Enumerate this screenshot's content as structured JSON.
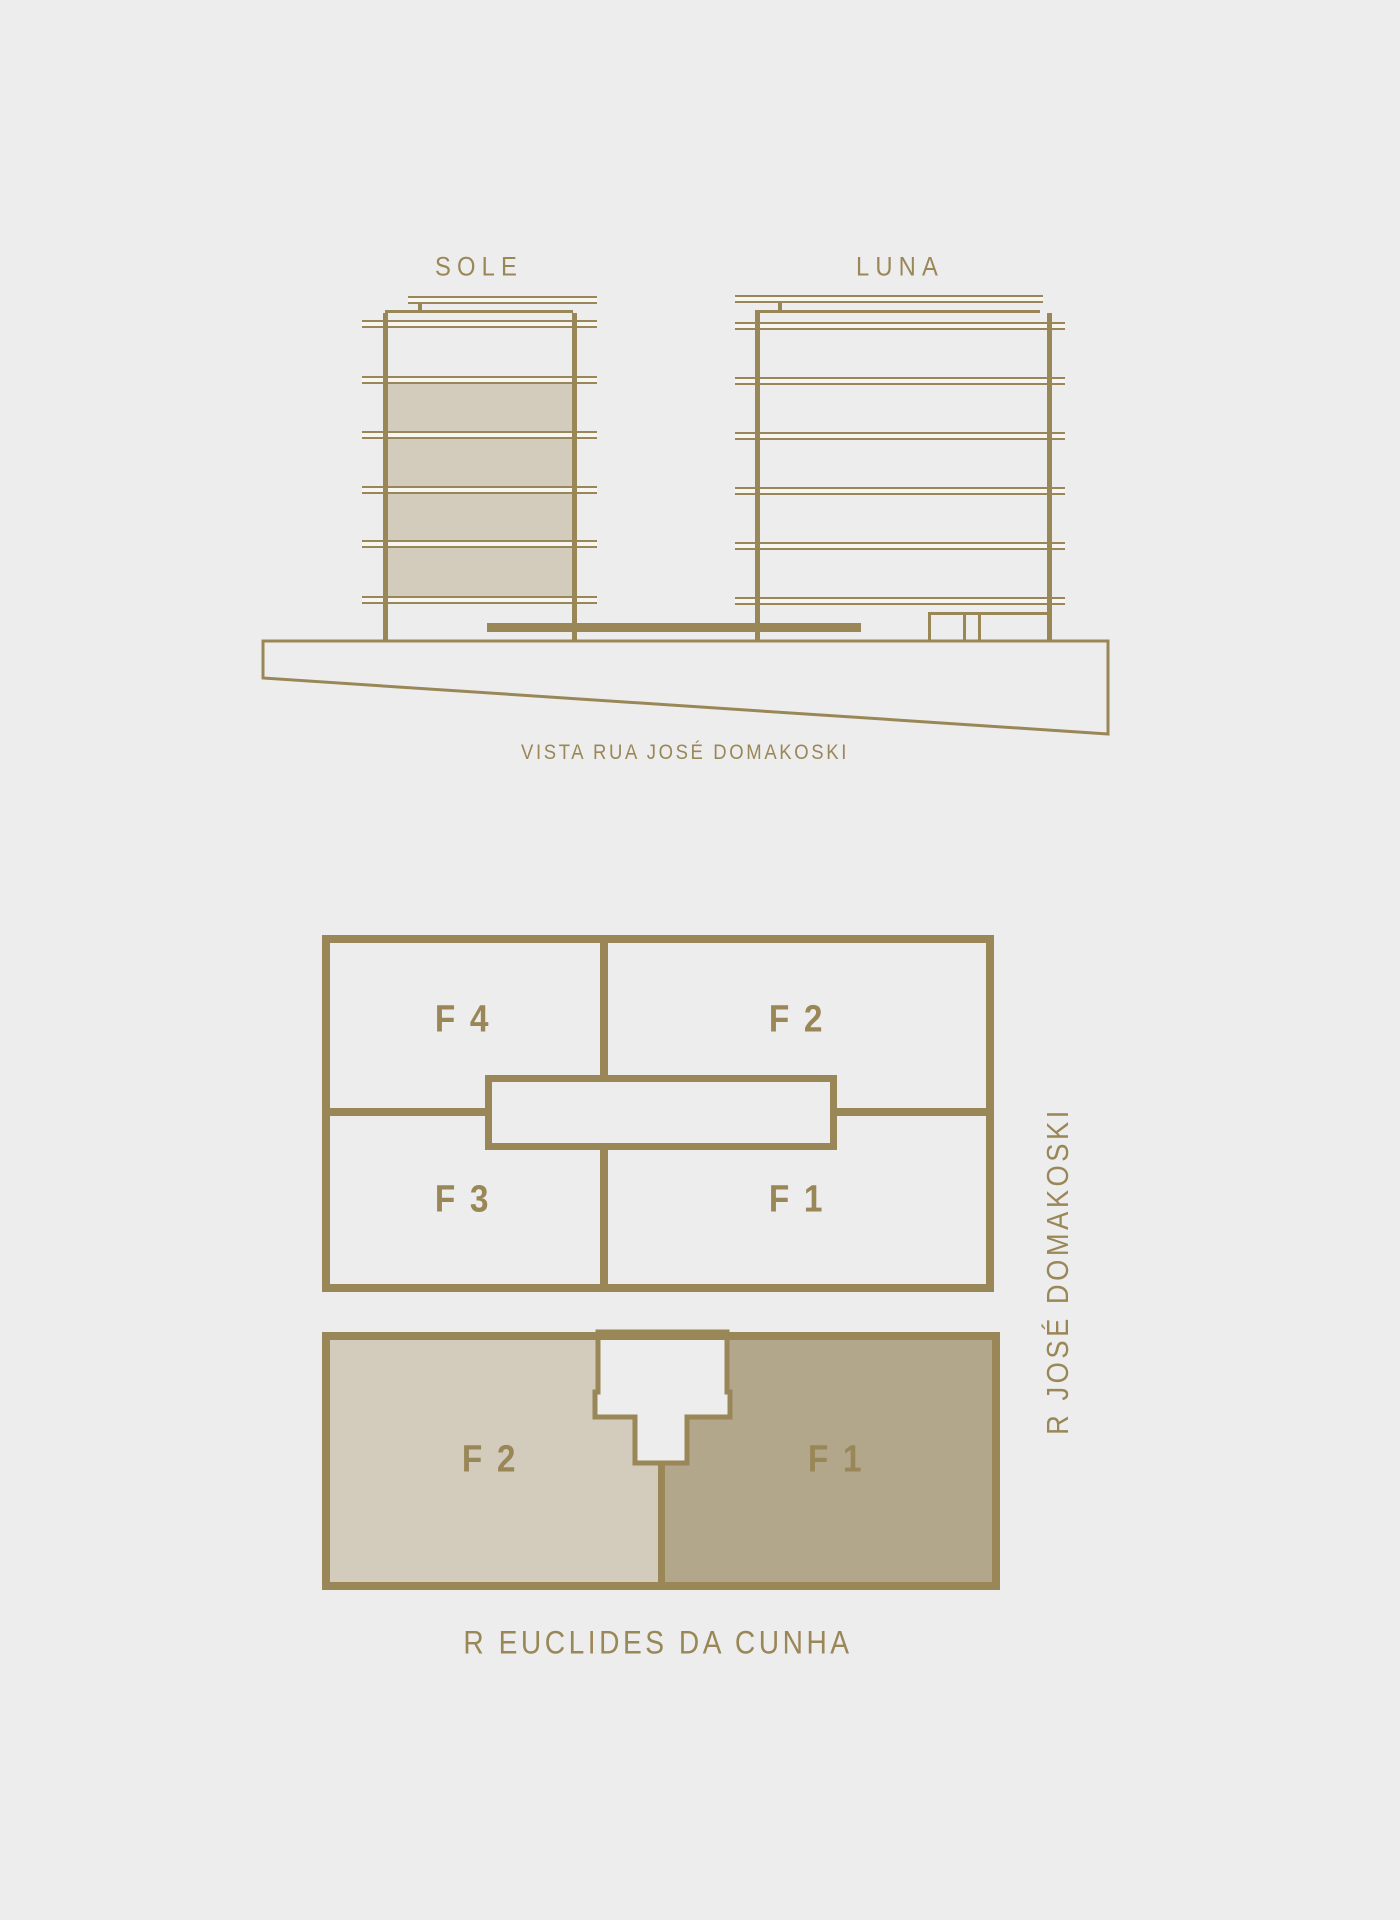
{
  "colors": {
    "bg": "#eeeded",
    "gold": "#9a8758",
    "beige": "#d3cbbc",
    "tan": "#b3a78b",
    "slabinner": "#f7f6f3"
  },
  "elevation": {
    "sole_label": "SOLE",
    "luna_label": "LUNA",
    "caption": "VISTA RUA JOSÉ DOMAKOSKI"
  },
  "typical_plan": {
    "f4": "F 4",
    "f2": "F 2",
    "f3": "F 3",
    "f1": "F 1"
  },
  "ground_plan": {
    "f2": "F 2",
    "f1": "F 1"
  },
  "streets": {
    "side": "R JOSÉ DOMAKOSKI",
    "bottom": "R EUCLIDES DA CUNHA"
  }
}
